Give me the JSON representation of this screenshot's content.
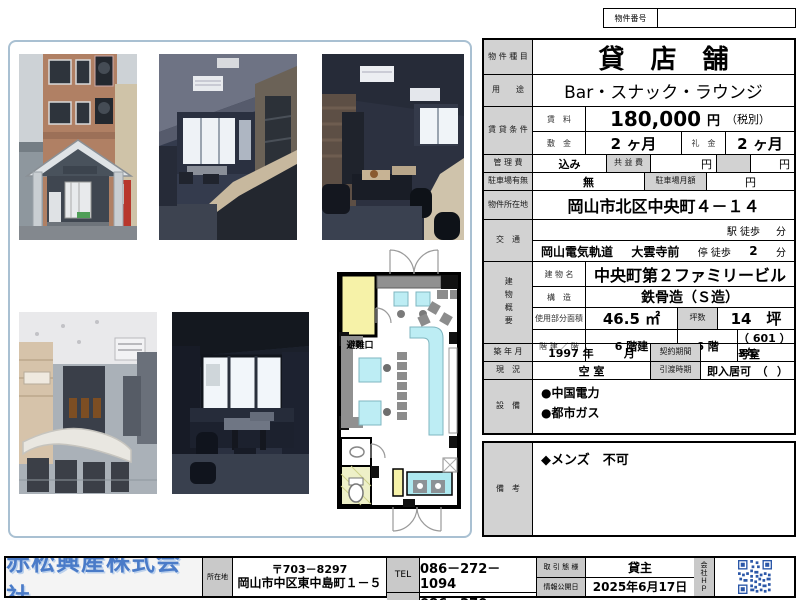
{
  "header": {
    "property_no_label": "物件番号",
    "property_no_value": ""
  },
  "table": {
    "type_label": "物 件 種 目",
    "type_value": "貸店舗",
    "use_label": "用　　途",
    "use_value": "Bar・スナック・ラウンジ",
    "cond_label": "賃 貸 条 件",
    "rent_label": "賃　料",
    "rent_value": "180,000",
    "rent_yen": "円",
    "rent_tax": "（税別）",
    "deposit_label": "敷　金",
    "deposit_value": "2 ヶ月",
    "keymoney_label": "礼　金",
    "keymoney_value": "2 ヶ月",
    "mgmt_label": "管 理 費",
    "mgmt_value": "込み",
    "common_label": "共 益 費",
    "common_yen": "円",
    "extra_yen": "円",
    "parking_label": "駐車場有無",
    "parking_value": "無",
    "parking_fee_label": "駐車場月額",
    "parking_fee_yen": "円",
    "addr_label": "物件所在地",
    "addr_value": "岡山市北区中央町４－１４",
    "transport_label": "交　通",
    "station_text": "駅 徒歩",
    "station_min": "分",
    "line_name": "岡山電気軌道",
    "stop_name": "大雲寺前",
    "stop_walk": "停 徒歩",
    "stop_min": "2",
    "stop_min_unit": "分",
    "bldg_label": "建物概要",
    "bldg_name_label": "建 物 名",
    "bldg_name": "中央町第２ファミリービル",
    "structure_label": "構　造",
    "structure_value": "鉄骨造（Ｓ造）",
    "area_label": "使用部分面積",
    "area_value": "46.5 ㎡",
    "tsubo_label": "坪数",
    "tsubo_value": "14　坪",
    "floors_label": "階 建 ／ 階",
    "floors_value": "6 階建",
    "floor_value": "6 階",
    "room_value": "（ 601 ）号室",
    "built_label": "築 年 月",
    "built_value": "1997 年",
    "built_month": "月",
    "contract_label": "契約期間",
    "contract_value": "3年",
    "status_label": "現　況",
    "status_value": "空 室",
    "handover_label": "引渡時期",
    "handover_value": "即入居可　（",
    "handover_close": "）",
    "equip_label": "設　備",
    "equip_1": "●中国電力",
    "equip_2": "●都市ガス"
  },
  "remarks": {
    "label": "備　考",
    "text": "◆メンズ　不可"
  },
  "floorplan": {
    "emergency_exit": "避難口"
  },
  "footer": {
    "company_name": "赤松興産株式会社",
    "address_label": "所在地",
    "postal_code": "〒703－8297",
    "address": "岡山市中区東中島町１－５",
    "tel_label": "TEL",
    "tel": "086－272－1094",
    "fax_label": "FAX",
    "fax": "086－270－0220",
    "deal_type_label": "取 引 態 様",
    "deal_type": "貸主",
    "publish_date_label": "情報公開日",
    "publish_date": "2025年6月17日",
    "company_hp_label": "会社ＨＰ"
  },
  "colors": {
    "accent_blue": "#4a7bc8",
    "label_gray": "#d2d2d2",
    "qr_blue": "#2b57a8",
    "panel_border": "#a9c0d2"
  }
}
